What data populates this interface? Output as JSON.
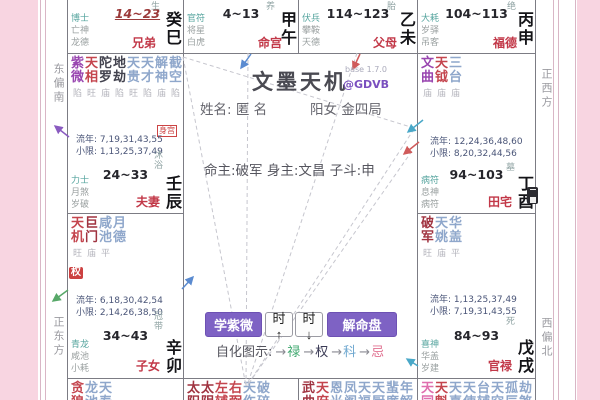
{
  "app": {
    "title": "文墨天机",
    "version": "base 1.7.0",
    "handle": "@GDVB"
  },
  "center": {
    "name_label": "姓名:",
    "name": "匿 名",
    "profile": "阳女 金四局",
    "destiny": "命主:破军 身主:文昌 子斗:申",
    "buttons": [
      "学紫微",
      "时↑",
      "时↓",
      "解命盘"
    ],
    "legend_label": "自化图示:",
    "legend_arrow": "→",
    "legend": [
      {
        "label": "禄",
        "color": "#3fa86f"
      },
      {
        "label": "权",
        "color": "#3a3a55"
      },
      {
        "label": "科",
        "color": "#6fa8d0"
      },
      {
        "label": "忌",
        "color": "#e07090"
      }
    ]
  },
  "compass": {
    "left_top": "东偏南",
    "left_bottom": "正东方",
    "right_top": "正西方",
    "right_bottom": "西偏北"
  },
  "palaces": {
    "si": {
      "gods": [
        "博士",
        "亡神",
        "龙德"
      ],
      "range": "14~23",
      "name": "兄弟",
      "stem": "癸巳",
      "stage": "长生"
    },
    "wu": {
      "gods": [
        "官符",
        "将星",
        "白虎"
      ],
      "range": "4~13",
      "name": "命宫",
      "stem": "甲午",
      "stage": "养"
    },
    "wei": {
      "gods": [
        "伏兵",
        "攀鞍",
        "天德"
      ],
      "range": "114~123",
      "name": "父母",
      "stem": "乙未",
      "stage": "胎"
    },
    "shen": {
      "gods": [
        "大耗",
        "岁驿",
        "吊客"
      ],
      "range": "104~113",
      "name": "福德",
      "stem": "丙申",
      "stage": "绝"
    },
    "chen": {
      "gods": [
        "力士",
        "月煞",
        "岁破"
      ],
      "range": "24~33",
      "name": "夫妻",
      "stem": "壬辰",
      "stage": "沐浴",
      "badge": "身宫",
      "liunian": "流年: 7,19,31,43,55",
      "xiaoxian": "小限: 1,13,25,37,49",
      "stars": [
        [
          "紫微",
          "陷",
          "purple"
        ],
        [
          "天相",
          "旺",
          "red"
        ],
        [
          "陀罗",
          "庙",
          "dark"
        ],
        [
          "地劫",
          "陷",
          "dark"
        ],
        [
          "天贵",
          "旺",
          "blue"
        ],
        [
          "天才",
          "陷",
          "blue"
        ],
        [
          "解神",
          "庙",
          "blue"
        ],
        [
          "截空",
          "陷",
          "blue"
        ],
        [
          "天虚",
          "陷",
          "blue"
        ]
      ]
    },
    "mao": {
      "gods": [
        "青龙",
        "咸池",
        "小耗"
      ],
      "range": "34~43",
      "name": "子女",
      "stem": "辛卯",
      "stage": "冠带",
      "badge": "权",
      "liunian": "流年: 6,18,30,42,54",
      "xiaoxian": "小限: 2,14,26,38,50",
      "stars": [
        [
          "天机",
          "旺",
          "red"
        ],
        [
          "巨门",
          "庙",
          "darkred"
        ],
        [
          "咸池",
          "平",
          "blue"
        ],
        [
          "月德",
          "",
          "blue"
        ]
      ]
    },
    "you": {
      "gods": [
        "病符",
        "息神",
        "病符"
      ],
      "range": "94~103",
      "name": "田宅",
      "stem": "丁酉",
      "stage": "墓",
      "liunian": "流年: 12,24,36,48,60",
      "xiaoxian": "小限: 8,20,32,44,56",
      "stars": [
        [
          "文曲",
          "庙",
          "purple"
        ],
        [
          "天钺",
          "庙",
          "red"
        ],
        [
          "三台",
          "庙",
          "blue"
        ]
      ]
    },
    "xu": {
      "gods": [
        "喜神",
        "华盖",
        "岁建"
      ],
      "range": "84~93",
      "name": "官禄",
      "stem": "戊戌",
      "stage": "死",
      "liunian": "流年: 1,13,25,37,49",
      "xiaoxian": "小限: 7,19,31,43,55",
      "stars": [
        [
          "破军",
          "旺",
          "darkred"
        ],
        [
          "天姚",
          "庙",
          "blue"
        ],
        [
          "华盖",
          "平",
          "blue"
        ]
      ]
    },
    "yin": {
      "stars": [
        [
          "贪狼",
          "",
          "red"
        ],
        [
          "龙池",
          "",
          "blue"
        ],
        [
          "天寿",
          "",
          "blue"
        ]
      ]
    },
    "chou": {
      "stars": [
        [
          "太阳",
          "",
          "darkred"
        ],
        [
          "太阴",
          "",
          "darkred"
        ],
        [
          "左辅",
          "",
          "red"
        ],
        [
          "右弼",
          "",
          "red"
        ],
        [
          "天伤",
          "",
          "blue"
        ],
        [
          "破碎",
          "",
          "blue"
        ]
      ]
    },
    "zi": {
      "stars": [
        [
          "武曲",
          "",
          "darkred"
        ],
        [
          "天府",
          "",
          "red"
        ],
        [
          "恩光",
          "",
          "blue"
        ],
        [
          "凤阁",
          "",
          "blue"
        ],
        [
          "天福",
          "",
          "blue"
        ],
        [
          "天厨",
          "",
          "blue"
        ],
        [
          "蜚廉",
          "",
          "blue"
        ],
        [
          "年解",
          "",
          "blue"
        ]
      ]
    },
    "hai": {
      "stars": [
        [
          "天同",
          "",
          "pink"
        ],
        [
          "天魁",
          "",
          "red"
        ],
        [
          "天喜",
          "",
          "blue"
        ],
        [
          "天使",
          "",
          "blue"
        ],
        [
          "台辅",
          "",
          "blue"
        ],
        [
          "天空",
          "",
          "blue"
        ],
        [
          "孤辰",
          "",
          "blue"
        ],
        [
          "劫煞",
          "",
          "blue"
        ]
      ]
    }
  }
}
